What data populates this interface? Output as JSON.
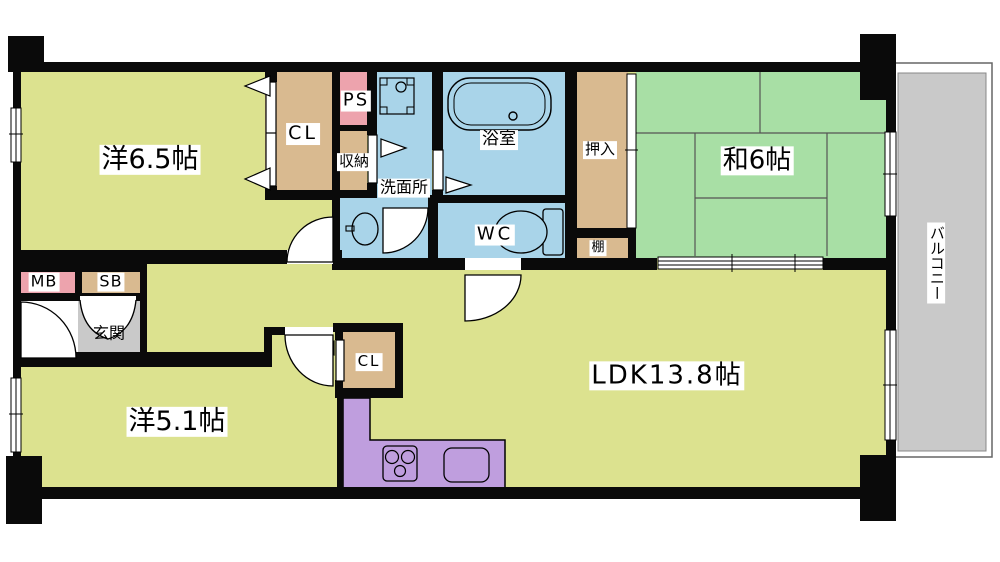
{
  "title": "apartment-floorplan",
  "rooms": [
    {
      "id": "western-6-5",
      "label": "洋6.5帖"
    },
    {
      "id": "closet-top",
      "label": "CL"
    },
    {
      "id": "pipe-space",
      "label": "PS"
    },
    {
      "id": "storage",
      "label": "収納"
    },
    {
      "id": "washroom",
      "label": "洗面所"
    },
    {
      "id": "bathroom",
      "label": "浴室"
    },
    {
      "id": "oshiire",
      "label": "押入"
    },
    {
      "id": "japanese-6",
      "label": "和6帖"
    },
    {
      "id": "wc",
      "label": "WC"
    },
    {
      "id": "shelf",
      "label": "棚"
    },
    {
      "id": "meter-box",
      "label": "MB"
    },
    {
      "id": "shoe-box",
      "label": "SB"
    },
    {
      "id": "entrance",
      "label": "玄関"
    },
    {
      "id": "closet-bottom",
      "label": "CL"
    },
    {
      "id": "western-5-1",
      "label": "洋5.1帖"
    },
    {
      "id": "ldk",
      "label": "LDK13.8帖"
    },
    {
      "id": "balcony",
      "label": "バルコニー"
    }
  ],
  "colors": {
    "room_yellow": "#dce28f",
    "tatami_green": "#a8dfa5",
    "water_blue": "#a9d4e9",
    "closet_tan": "#d9ba90",
    "pipe_pink": "#eda3ad",
    "kitchen_purple": "#bf9ede",
    "entry_gray": "#c9c9c9",
    "wall_black": "#0a0a0a",
    "white": "#ffffff"
  }
}
